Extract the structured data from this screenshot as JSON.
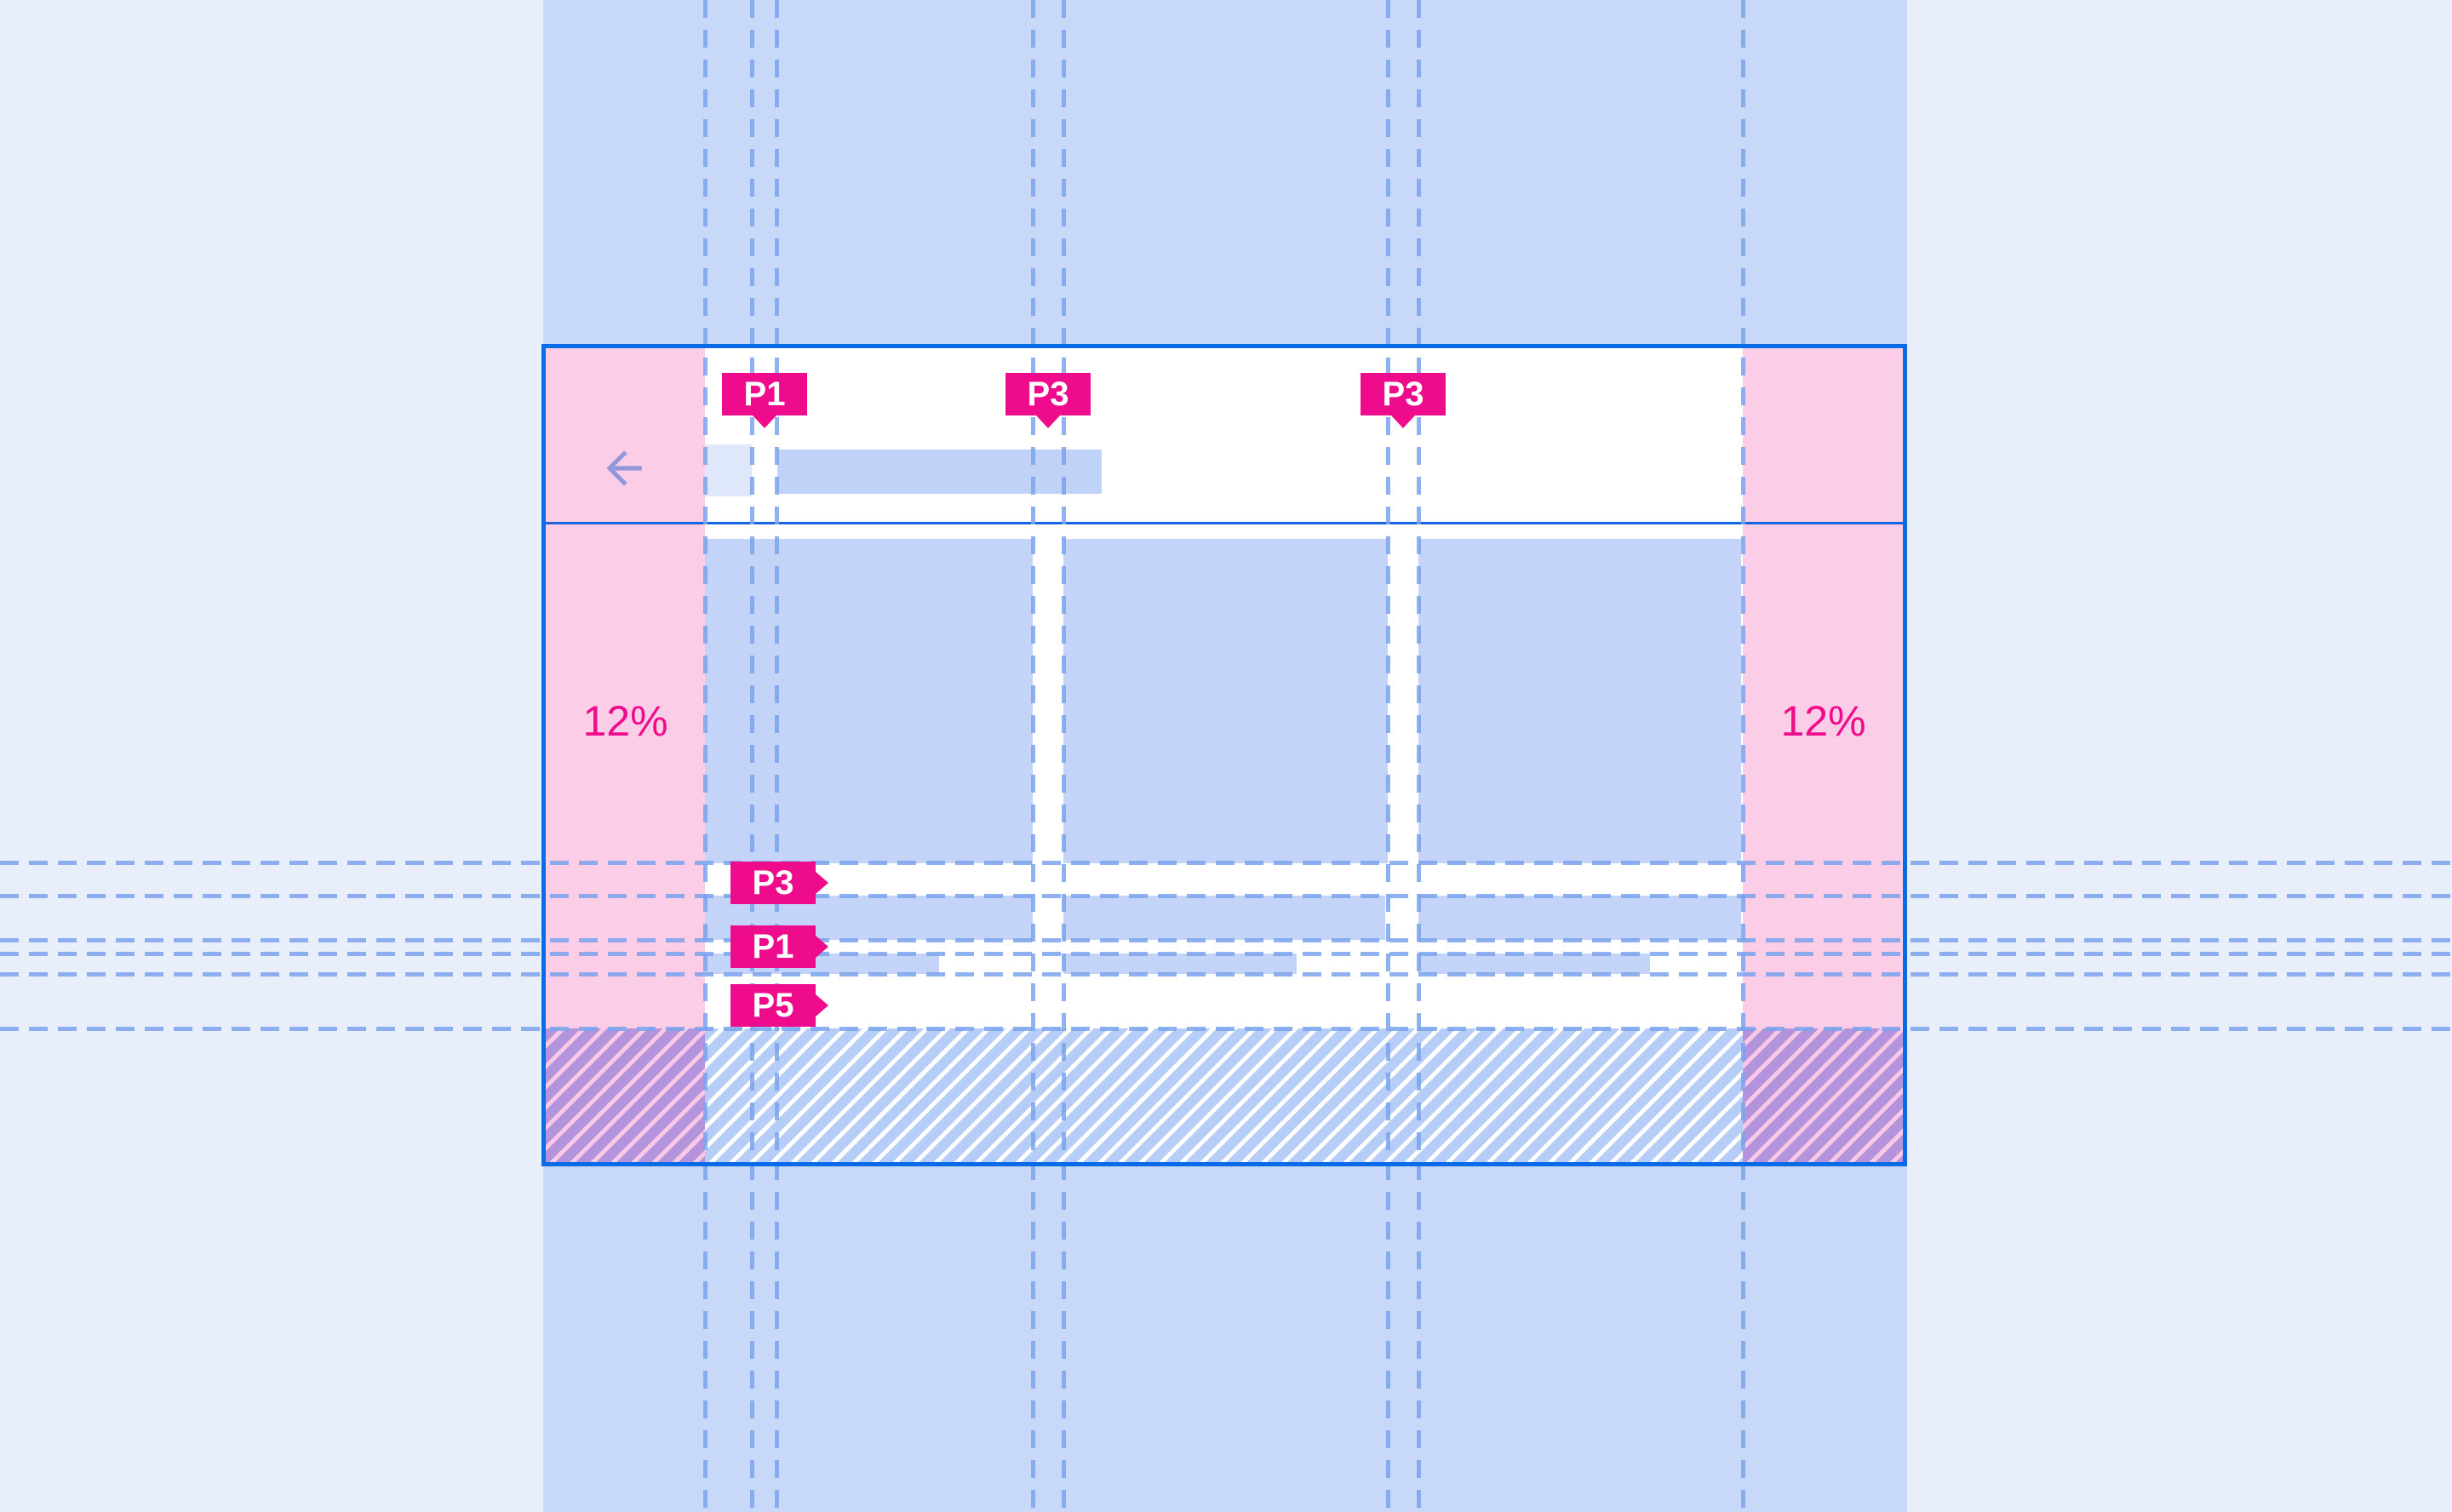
{
  "meta": {
    "description": "Responsive layout grid spec mock with 12% margins and padding keylines"
  },
  "colors": {
    "page_background": "#E9EEFB",
    "column_band": "#C8D8F8",
    "frame_border": "#0A6BE7",
    "margin_pink": "#FCCDE7",
    "accent_magenta": "#EE0B8C",
    "placeholder_blue": "#C3D4F8",
    "keyline_blue": "#7BA3EC",
    "hatch_purple": "#B293DC"
  },
  "header": {
    "back_icon": "arrow-left",
    "title_placeholder": "",
    "icon_placeholder": ""
  },
  "annotations": {
    "top": [
      {
        "text": "P1"
      },
      {
        "text": "P3"
      },
      {
        "text": "P3"
      }
    ],
    "rows": [
      {
        "text": "P3"
      },
      {
        "text": "P1"
      },
      {
        "text": "P5"
      }
    ],
    "left_margin_label": "12%",
    "right_margin_label": "12%"
  }
}
